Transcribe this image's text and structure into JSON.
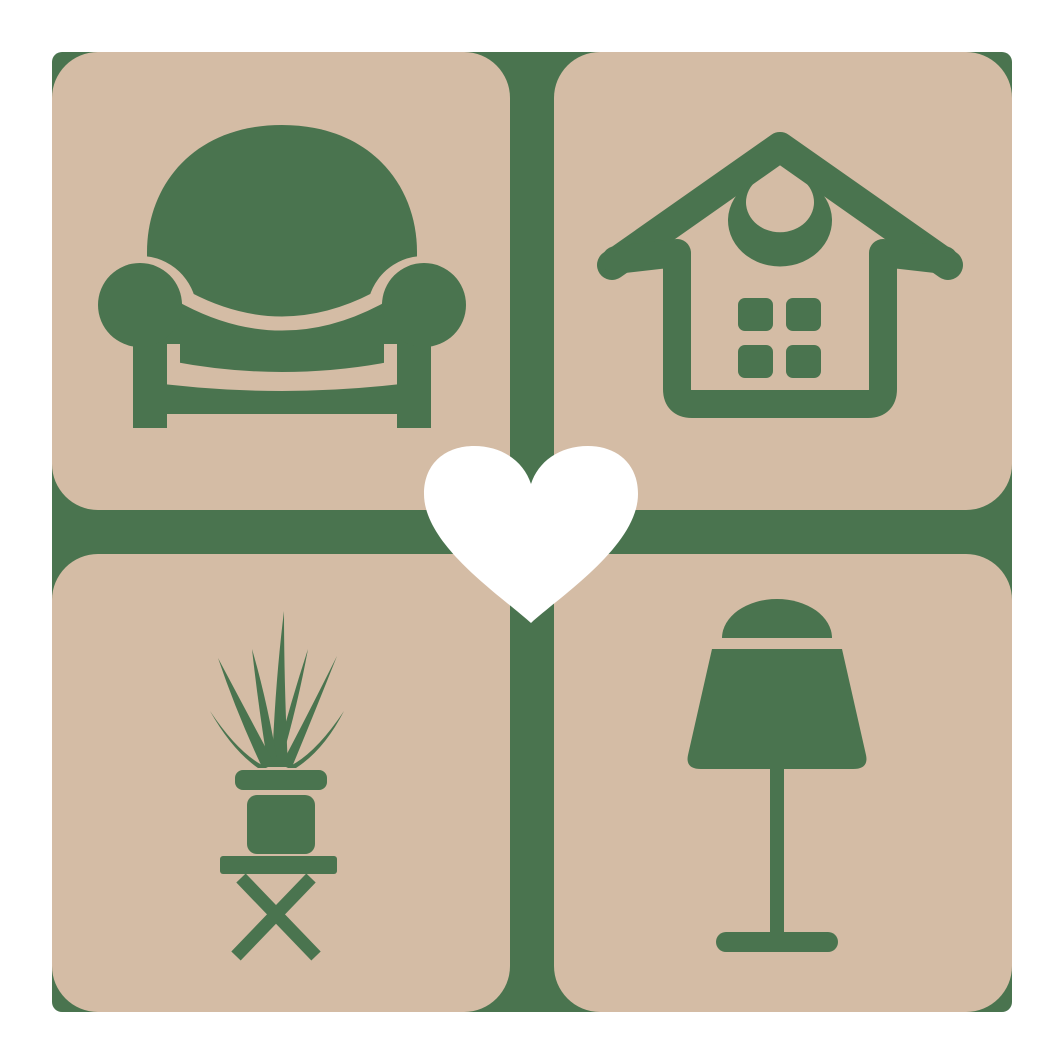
{
  "logo": {
    "colors": {
      "green": "#4A744F",
      "tan": "#D4BCA5",
      "white": "#FFFFFF"
    },
    "backdrop": {
      "name": "green-cross-backdrop"
    },
    "tiles": [
      {
        "position": "top-left",
        "icon": "armchair-icon"
      },
      {
        "position": "top-right",
        "icon": "house-icon"
      },
      {
        "position": "bottom-left",
        "icon": "potted-plant-icon"
      },
      {
        "position": "bottom-right",
        "icon": "table-lamp-icon"
      }
    ],
    "center": {
      "icon": "heart-icon"
    }
  }
}
